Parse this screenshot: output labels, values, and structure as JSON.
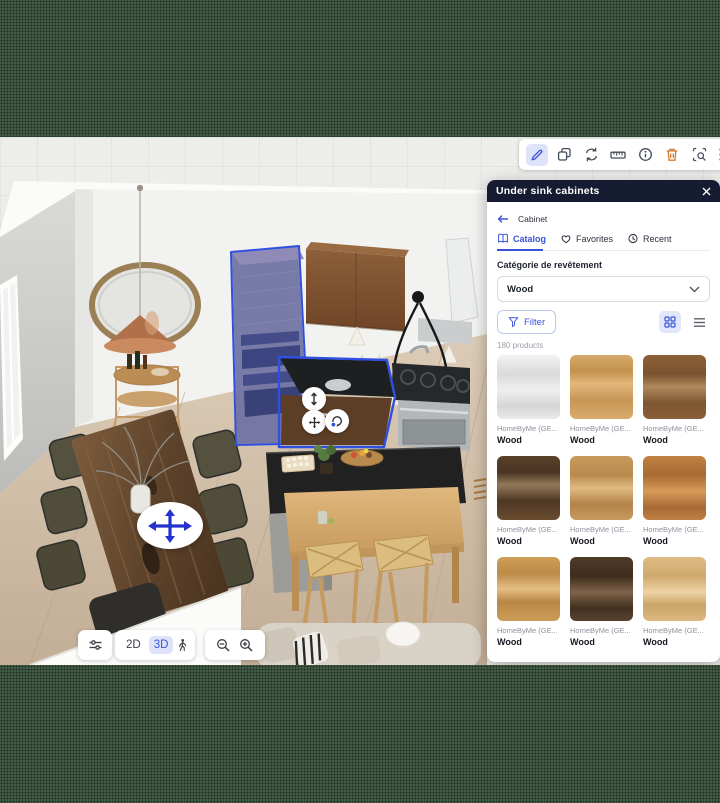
{
  "colors": {
    "accent_blue": "#3b53d8",
    "selection_blue": "#2f4fe0",
    "danger_orange": "#cf7b33",
    "panel_header_bg": "#151c31",
    "letterbox_green": "#4a664f"
  },
  "top_toolbar": {
    "icons": [
      "pencil-edit",
      "duplicate",
      "replace",
      "measure",
      "info",
      "trash",
      "zone-select",
      "drag-grip"
    ],
    "active_icon": "pencil-edit"
  },
  "panel": {
    "title": "Under sink cabinets",
    "back_label": "Cabinet",
    "tabs": [
      {
        "label": "Catalog",
        "active": true
      },
      {
        "label": "Favorites",
        "active": false
      },
      {
        "label": "Recent",
        "active": false
      }
    ],
    "category_label": "Catégorie de revêtement",
    "category_value": "Wood",
    "filter_label": "Filter",
    "count_label": "180 products",
    "products": [
      {
        "brand": "HomeByMe (GE...",
        "name": "Wood",
        "swatch": "linear-gradient(180deg,#f2f2f2,#dadada 30%,#efefef 55%,#d6d6d6 80%,#e9e9e9)"
      },
      {
        "brand": "HomeByMe (GE...",
        "name": "Wood",
        "swatch": "linear-gradient(180deg,#d7a969,#c3924f 25%,#e3b87c 45%,#c79655 70%,#d9ab6b)"
      },
      {
        "brand": "HomeByMe (GE...",
        "name": "Wood",
        "swatch": "linear-gradient(180deg,#8d6136,#7a5230 30%,#b08a5c 50%,#7d5631 75%,#8a5f38)"
      },
      {
        "brand": "HomeByMe (GE...",
        "name": "Wood",
        "swatch": "linear-gradient(180deg,#5a4129,#4a3421 25%,#94785a 45%,#4e3724 70%,#6b4d31)"
      },
      {
        "brand": "HomeByMe (GE...",
        "name": "Wood",
        "swatch": "linear-gradient(180deg,#c89a5c,#b98a4e 30%,#e0ba82 50%,#b3834a 75%,#c89a5e)"
      },
      {
        "brand": "HomeByMe (GE...",
        "name": "Wood",
        "swatch": "linear-gradient(180deg,#c08142,#a96b33 30%,#d89a58 55%,#a86a34 80%,#bd7f42)"
      },
      {
        "brand": "HomeByMe (GE...",
        "name": "Wood",
        "swatch": "linear-gradient(180deg,#cfa05a,#bb8a47 25%,#e5be82 50%,#b98745 70%,#cb9c57)"
      },
      {
        "brand": "HomeByMe (GE...",
        "name": "Wood",
        "swatch": "linear-gradient(180deg,#4f3a28,#3f2d1e 30%,#7e6349 55%,#42301f 80%,#584232)"
      },
      {
        "brand": "HomeByMe (GE...",
        "name": "Wood",
        "swatch": "linear-gradient(180deg,#dfbc85,#cfa96e 30%,#eed3a4 55%,#caa468 75%,#ddb981)"
      }
    ]
  },
  "view_controls": {
    "label_2d": "2D",
    "label_3d": "3D",
    "active_mode": "3D"
  }
}
